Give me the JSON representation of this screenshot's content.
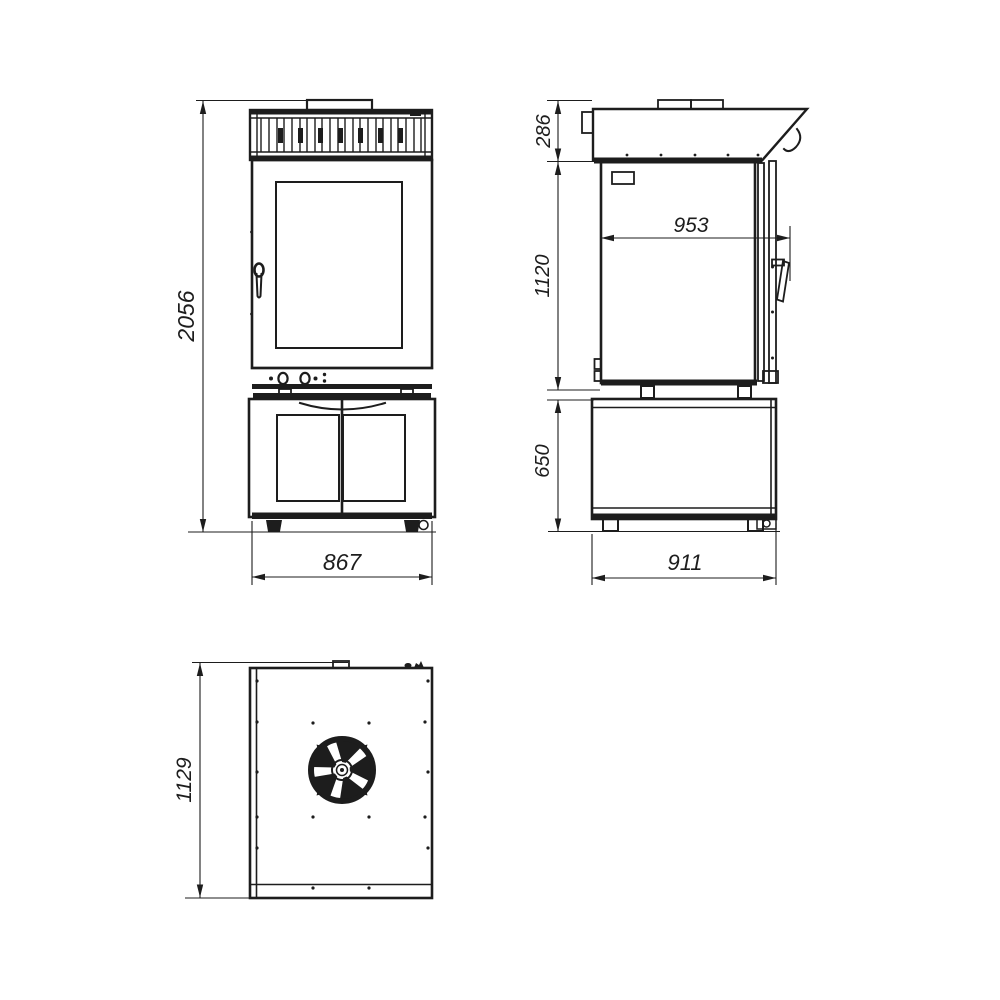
{
  "meta": {
    "drawing_type": "technical dimension drawing, three orthographic views of a combi oven on a base cabinet",
    "background_color": "#ffffff",
    "line_color": "#1d1d1d"
  },
  "dimensions": {
    "overall_height": "2056",
    "front_width": "867",
    "hood_height": "286",
    "body_height": "1120",
    "base_height": "650",
    "depth_over_handle": "953",
    "base_depth": "911",
    "overall_depth": "1129"
  }
}
